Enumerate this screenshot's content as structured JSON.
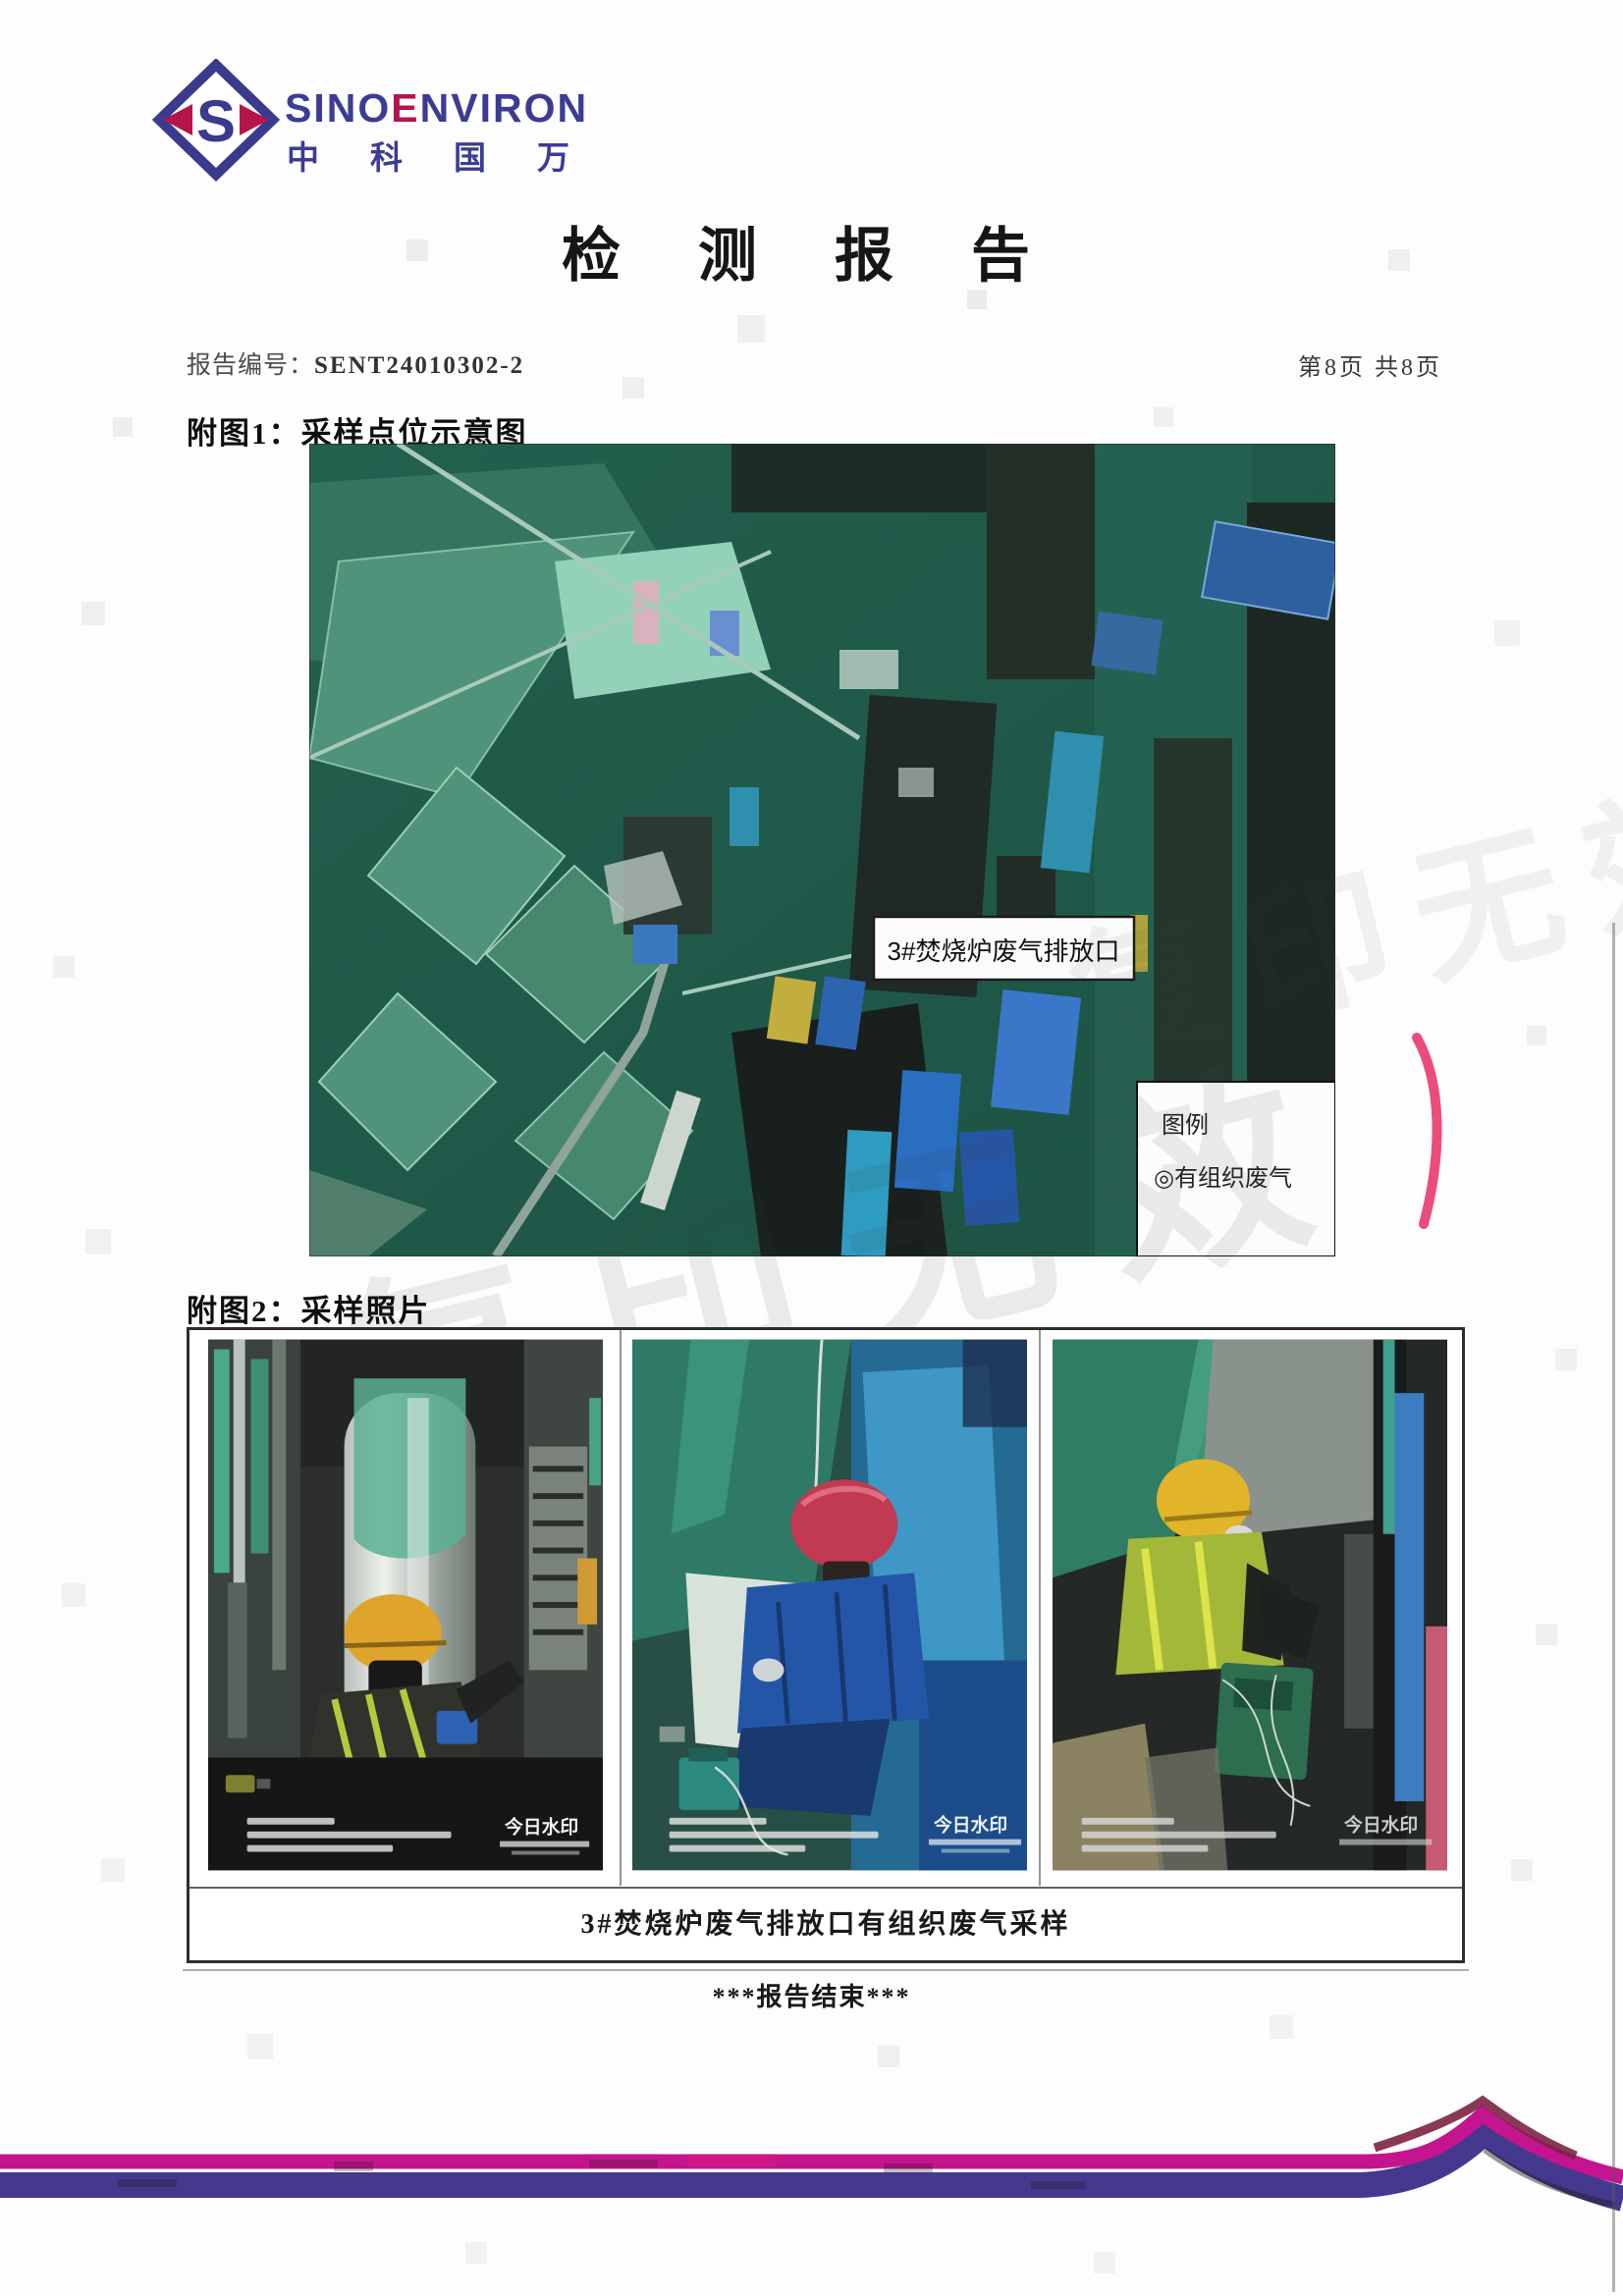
{
  "logo": {
    "monogram": "S",
    "brand_sino": "SINO",
    "brand_e": "E",
    "brand_nviron": "NVIRON",
    "brand_cn": "中科国万"
  },
  "header": {
    "title": "检 测 报 告",
    "report_no_label": "报告编号：",
    "report_no": "SENT24010302-2",
    "page_info": "第8页 共8页"
  },
  "figure1": {
    "heading": "附图1：采样点位示意图",
    "map_label": "3#焚烧炉废气排放口",
    "legend_title": "图例",
    "legend_item": "◎有组织废气"
  },
  "figure2": {
    "heading": "附图2：采样照片",
    "caption": "3#焚烧炉废气排放口有组织废气采样",
    "watermark_brand": "今日水印"
  },
  "footer": {
    "end_text": "***报告结束***"
  },
  "scan": {
    "watermark_text": "复印无效"
  },
  "colors": {
    "brand_navy": "#3c3c94",
    "brand_magenta": "#b5154a",
    "band_magenta": "#c4158e",
    "band_indigo": "#44398e",
    "map_green": "#205c4b"
  }
}
